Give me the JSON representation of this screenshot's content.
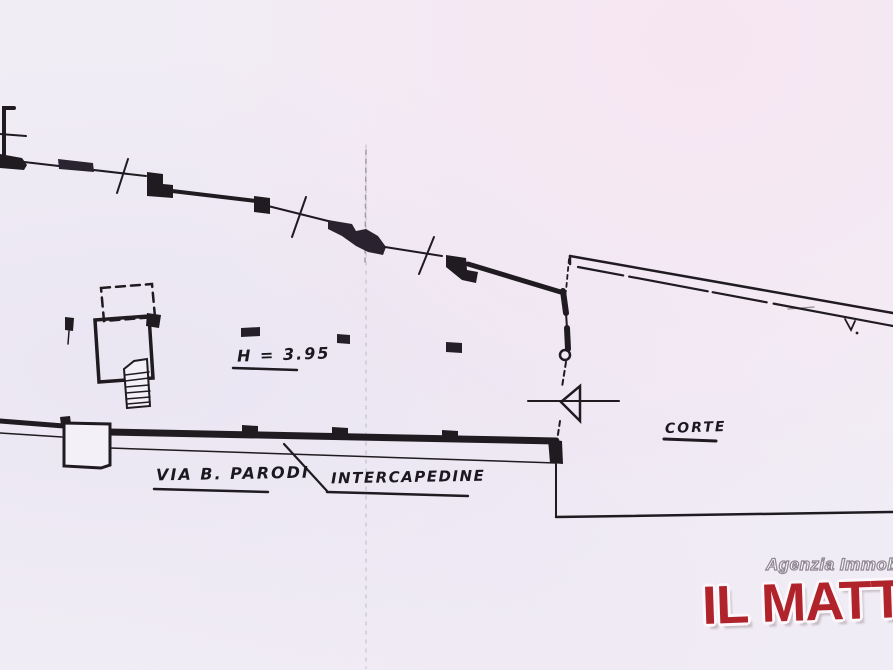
{
  "plan": {
    "labels": {
      "height": "H = 3.95",
      "street": "VIA B. PARODI",
      "gap": "INTERCAPEDINE",
      "court": "CORTE"
    }
  },
  "watermark": {
    "agency_line": "Agenzia Immobiliare",
    "brand": "IL MATTONE",
    "brand_color": "#b0232b"
  },
  "canvas": {
    "background": "#f1edf5",
    "ink": "#1f1b21"
  }
}
